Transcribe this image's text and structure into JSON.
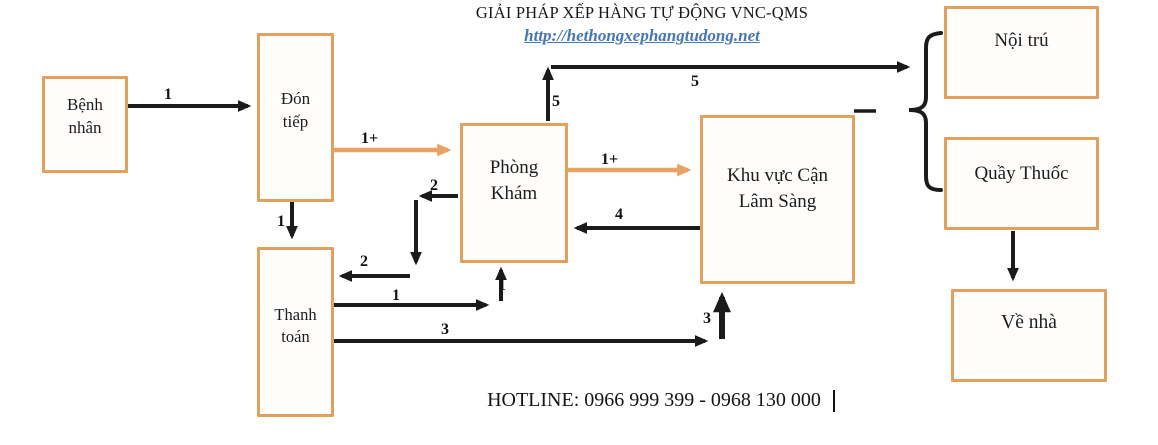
{
  "header": {
    "title": "GIẢI PHÁP XẾP HÀNG TỰ ĐỘNG VNC-QMS",
    "url": "http://hethongxephangtudong.net"
  },
  "footer": {
    "hotline": "HOTLINE: 0966 999 399 - 0968 130 000"
  },
  "nodes": {
    "benh_nhan": "Bệnh nhân",
    "don_tiep": "Đón tiếp",
    "thanh_toan": "Thanh toán",
    "phong_kham": "Phòng Khám",
    "khu_vuc_can_lam_sang": "Khu vực Cận Lâm Sàng",
    "noi_tru": "Nội trú",
    "quay_thuoc": "Quầy Thuốc",
    "ve_nha": "Về nhà"
  },
  "arrow_labels": [
    "1",
    "1",
    "1+",
    "2",
    "2",
    "1",
    "1",
    "1+",
    "4",
    "3",
    "3",
    "5",
    "5"
  ],
  "edges": [
    {
      "from": "Bệnh nhân",
      "to": "Đón tiếp",
      "label": "1",
      "style": "black"
    },
    {
      "from": "Đón tiếp",
      "to": "Thanh toán",
      "label": "1",
      "style": "black"
    },
    {
      "from": "Đón tiếp",
      "to": "Phòng Khám",
      "label": "1+",
      "style": "orange"
    },
    {
      "from": "Phòng Khám",
      "to": "Thanh toán",
      "label": "2",
      "style": "black"
    },
    {
      "from": "Thanh toán",
      "to": "Phòng Khám",
      "label": "1",
      "style": "black"
    },
    {
      "from": "Phòng Khám",
      "to": "Khu vực Cận Lâm Sàng",
      "label": "1+",
      "style": "orange"
    },
    {
      "from": "Khu vực Cận Lâm Sàng",
      "to": "Phòng Khám",
      "label": "4",
      "style": "black"
    },
    {
      "from": "Thanh toán",
      "to": "Khu vực Cận Lâm Sàng",
      "label": "3",
      "style": "black"
    },
    {
      "from": "Phòng Khám",
      "to": "Nội trú / Quầy Thuốc",
      "label": "5",
      "style": "black"
    },
    {
      "from": "Quầy Thuốc",
      "to": "Về nhà",
      "label": "",
      "style": "black"
    }
  ],
  "colors": {
    "box_border": "#E2A05E",
    "orange_arrow": "#E8A262",
    "black_arrow": "#1B1B1B",
    "link_blue": "#4677B4"
  }
}
